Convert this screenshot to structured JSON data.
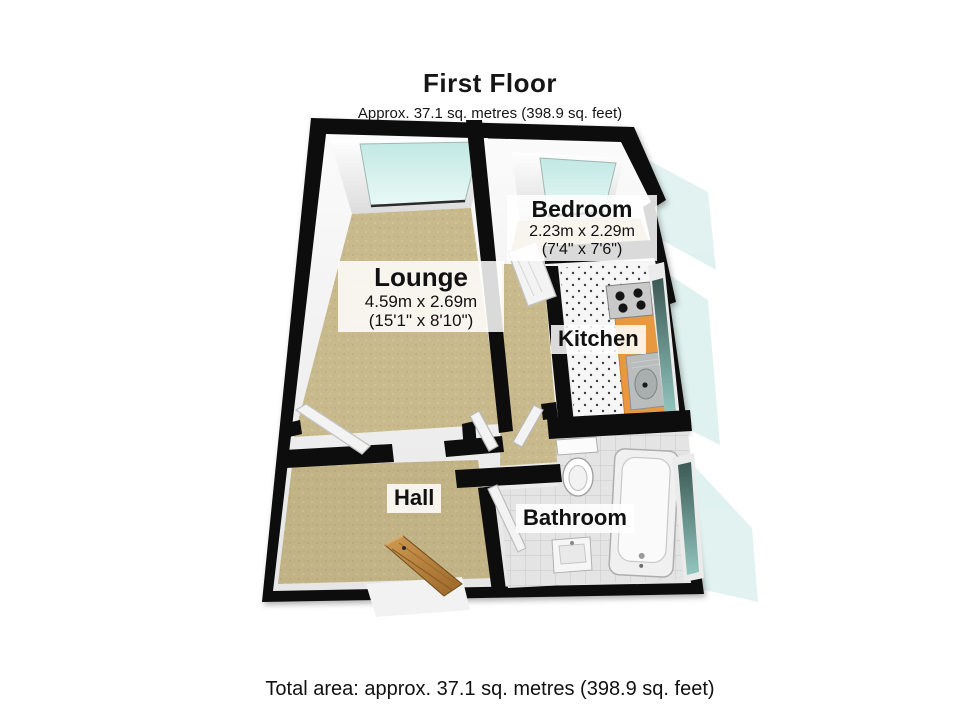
{
  "header": {
    "title": "First Floor",
    "subtitle": "Approx. 37.1 sq. metres (398.9 sq. feet)"
  },
  "footer": {
    "total_area": "Total area: approx. 37.1 sq. metres (398.9 sq. feet)"
  },
  "floor_plan": {
    "rooms": [
      {
        "name": "Lounge",
        "dimensions_metric": "4.59m x 2.69m",
        "dimensions_imperial": "(15'1\" x 8'10\")"
      },
      {
        "name": "Bedroom",
        "dimensions_metric": "2.23m x 2.29m",
        "dimensions_imperial": "(7'4\" x 7'6\")"
      },
      {
        "name": "Kitchen"
      },
      {
        "name": "Hall"
      },
      {
        "name": "Bathroom"
      }
    ],
    "fixtures": [
      "bathtub",
      "toilet",
      "wash-basin",
      "kitchen-sink",
      "gas-hob",
      "worktop",
      "entrance-door",
      "internal-doors",
      "windows"
    ],
    "colors": {
      "wall": "#0d0d0d",
      "carpet": "#c9ba8d",
      "window_glass": "#cdeae6",
      "window_pane_dark": "#3c5955",
      "kitchen_worktop": "#e8993f",
      "kitchen_tile": "#f6f6f6",
      "bathroom_tile": "#e4e4e4",
      "wood_door": "#b5803f",
      "label_background": "rgba(255,255,255,0.85)"
    }
  }
}
